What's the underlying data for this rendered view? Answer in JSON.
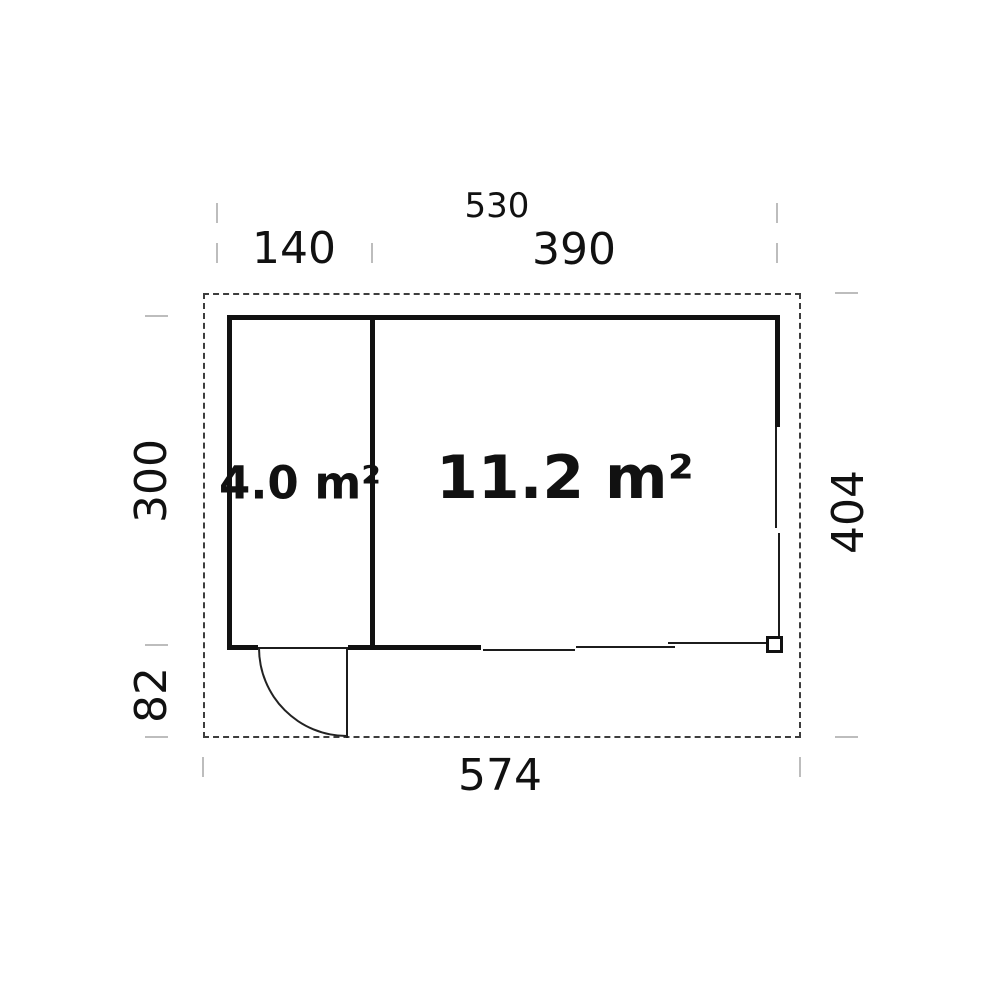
{
  "plan": {
    "title": "shed-floor-plan",
    "rooms": [
      {
        "name": "small-room",
        "area_label": "4.0 m²"
      },
      {
        "name": "main-room",
        "area_label": "11.2 m²"
      }
    ],
    "dimensions": {
      "top_total": "530",
      "top_left_section": "140",
      "top_right_section": "390",
      "left_wall_height": "300",
      "left_lower_overhang": "82",
      "right_total_depth": "404",
      "bottom_total_width": "574"
    },
    "colors": {
      "wall": "#111111",
      "dashed_outline": "#3d3d3d",
      "tick": "#bdbdbd",
      "text": "#111111",
      "background": "#ffffff"
    }
  }
}
